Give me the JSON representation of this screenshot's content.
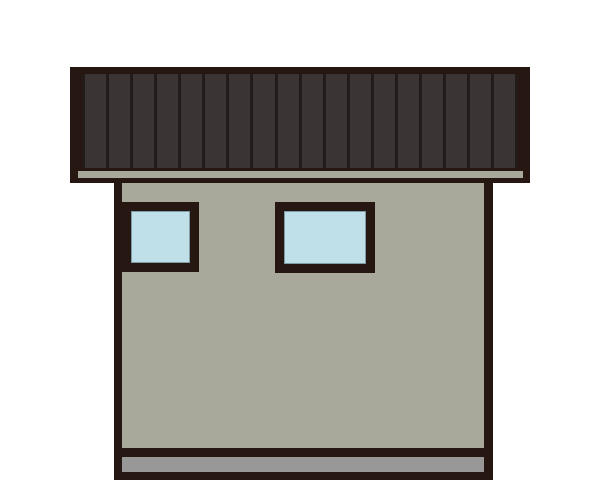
{
  "scene": {
    "type": "flat-roof-house-front-elevation-illustration",
    "roof": {
      "slat_count": 18,
      "fill_color": "#3a3534",
      "slat_line_color": "#231b19",
      "outline_color": "#261712",
      "fascia_color": "#a8a99b"
    },
    "wall": {
      "fill_color": "#a8a99b",
      "outline_color": "#261712"
    },
    "windows": [
      {
        "name": "left",
        "glass_color": "#bfe0e8",
        "frame_color": "#261712",
        "glass_edge_color": "#7f9ba4"
      },
      {
        "name": "right",
        "glass_color": "#bfe0e8",
        "frame_color": "#261712",
        "glass_edge_color": "#7f9ba4"
      }
    ],
    "foundation": {
      "fill_color": "#999899"
    }
  },
  "colors": {
    "background": "#ffffff",
    "outline": "#261712",
    "roof-fill": "#3a3534",
    "roof-line": "#231b19",
    "fascia": "#a8a99b",
    "wall": "#a8a99b",
    "glass": "#bfe0e8",
    "glass-edge": "#7f9ba4",
    "base": "#999899"
  }
}
